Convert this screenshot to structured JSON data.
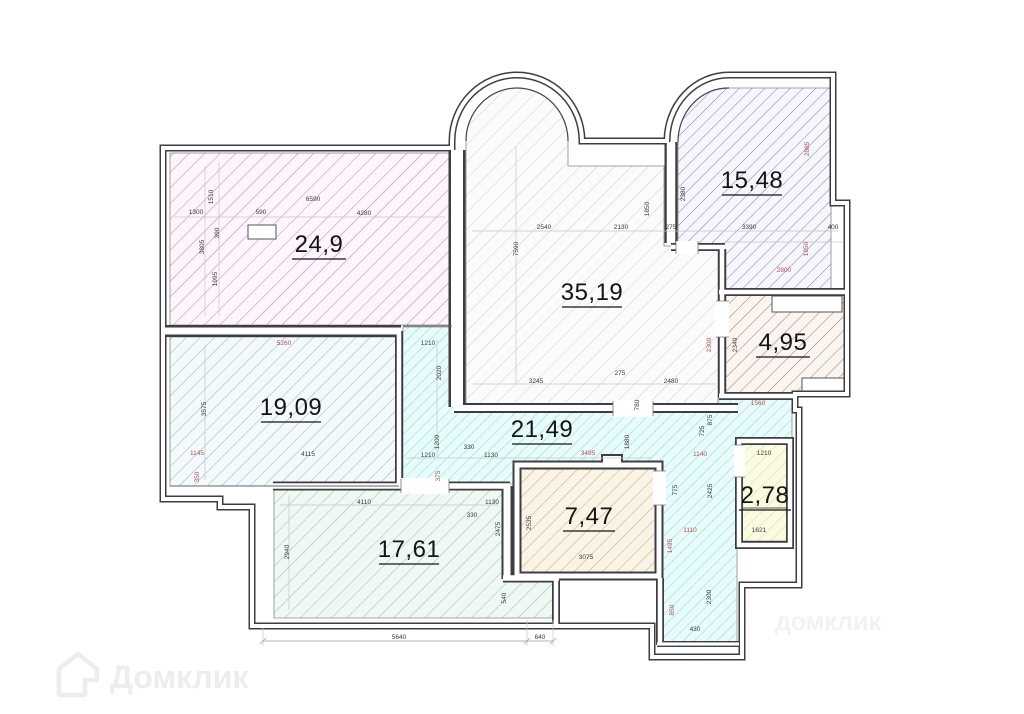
{
  "plan": {
    "watermark": {
      "brand": "Домклик",
      "faint": "домклик"
    },
    "colors": {
      "wall": "#3d3d44",
      "dim_dark": "#3a3a3a",
      "dim_red": "#b0524a",
      "hatch_24_9": "#c875c8",
      "hatch_19_09": "#8fb3cb",
      "hatch_35_19": "#d5cbd8",
      "hatch_15_48": "#6074b8",
      "hatch_4_95": "#9b7766",
      "hatch_21_49": "#76dede",
      "hatch_2_78": "#e0dc85",
      "hatch_7_47": "#c8a678",
      "hatch_17_61": "#8ec4a6",
      "watermark": "#ededed"
    },
    "areas": [
      {
        "name": "room-24-9",
        "label": "24,9"
      },
      {
        "name": "room-19-09",
        "label": "19,09"
      },
      {
        "name": "room-35-19",
        "label": "35,19"
      },
      {
        "name": "room-15-48",
        "label": "15,48"
      },
      {
        "name": "room-4-95",
        "label": "4,95"
      },
      {
        "name": "room-21-49",
        "label": "21,49"
      },
      {
        "name": "room-2-78",
        "label": "2,78"
      },
      {
        "name": "room-7-47",
        "label": "7,47"
      },
      {
        "name": "room-17-61",
        "label": "17,61"
      }
    ],
    "dims": [
      {
        "t": "1300"
      },
      {
        "t": "1510"
      },
      {
        "t": "590"
      },
      {
        "t": "6590"
      },
      {
        "t": "4280"
      },
      {
        "t": "390"
      },
      {
        "t": "3805"
      },
      {
        "t": "1995"
      },
      {
        "t": "5260"
      },
      {
        "t": "3575"
      },
      {
        "t": "1145"
      },
      {
        "t": "4115"
      },
      {
        "t": "350"
      },
      {
        "t": "1210"
      },
      {
        "t": "2020"
      },
      {
        "t": "2540"
      },
      {
        "t": "2130"
      },
      {
        "t": "275"
      },
      {
        "t": "1850"
      },
      {
        "t": "2380"
      },
      {
        "t": "7590"
      },
      {
        "t": "3245"
      },
      {
        "t": "275"
      },
      {
        "t": "2480"
      },
      {
        "t": "780"
      },
      {
        "t": "1880"
      },
      {
        "t": "1200"
      },
      {
        "t": "330"
      },
      {
        "t": "1130"
      },
      {
        "t": "3495"
      },
      {
        "t": "1210"
      },
      {
        "t": "375"
      },
      {
        "t": "2885"
      },
      {
        "t": "3390"
      },
      {
        "t": "400"
      },
      {
        "t": "1950"
      },
      {
        "t": "2800"
      },
      {
        "t": "2340"
      },
      {
        "t": "2300"
      },
      {
        "t": "1560"
      },
      {
        "t": "875"
      },
      {
        "t": "725"
      },
      {
        "t": "1140"
      },
      {
        "t": "775"
      },
      {
        "t": "2425"
      },
      {
        "t": "1110"
      },
      {
        "t": "1495"
      },
      {
        "t": "850"
      },
      {
        "t": "2300"
      },
      {
        "t": "430"
      },
      {
        "t": "1210"
      },
      {
        "t": "1621"
      },
      {
        "t": "2535"
      },
      {
        "t": "3075"
      },
      {
        "t": "4110"
      },
      {
        "t": "1130"
      },
      {
        "t": "330"
      },
      {
        "t": "2475"
      },
      {
        "t": "2940"
      },
      {
        "t": "540"
      },
      {
        "t": "5640"
      },
      {
        "t": "640"
      }
    ]
  }
}
